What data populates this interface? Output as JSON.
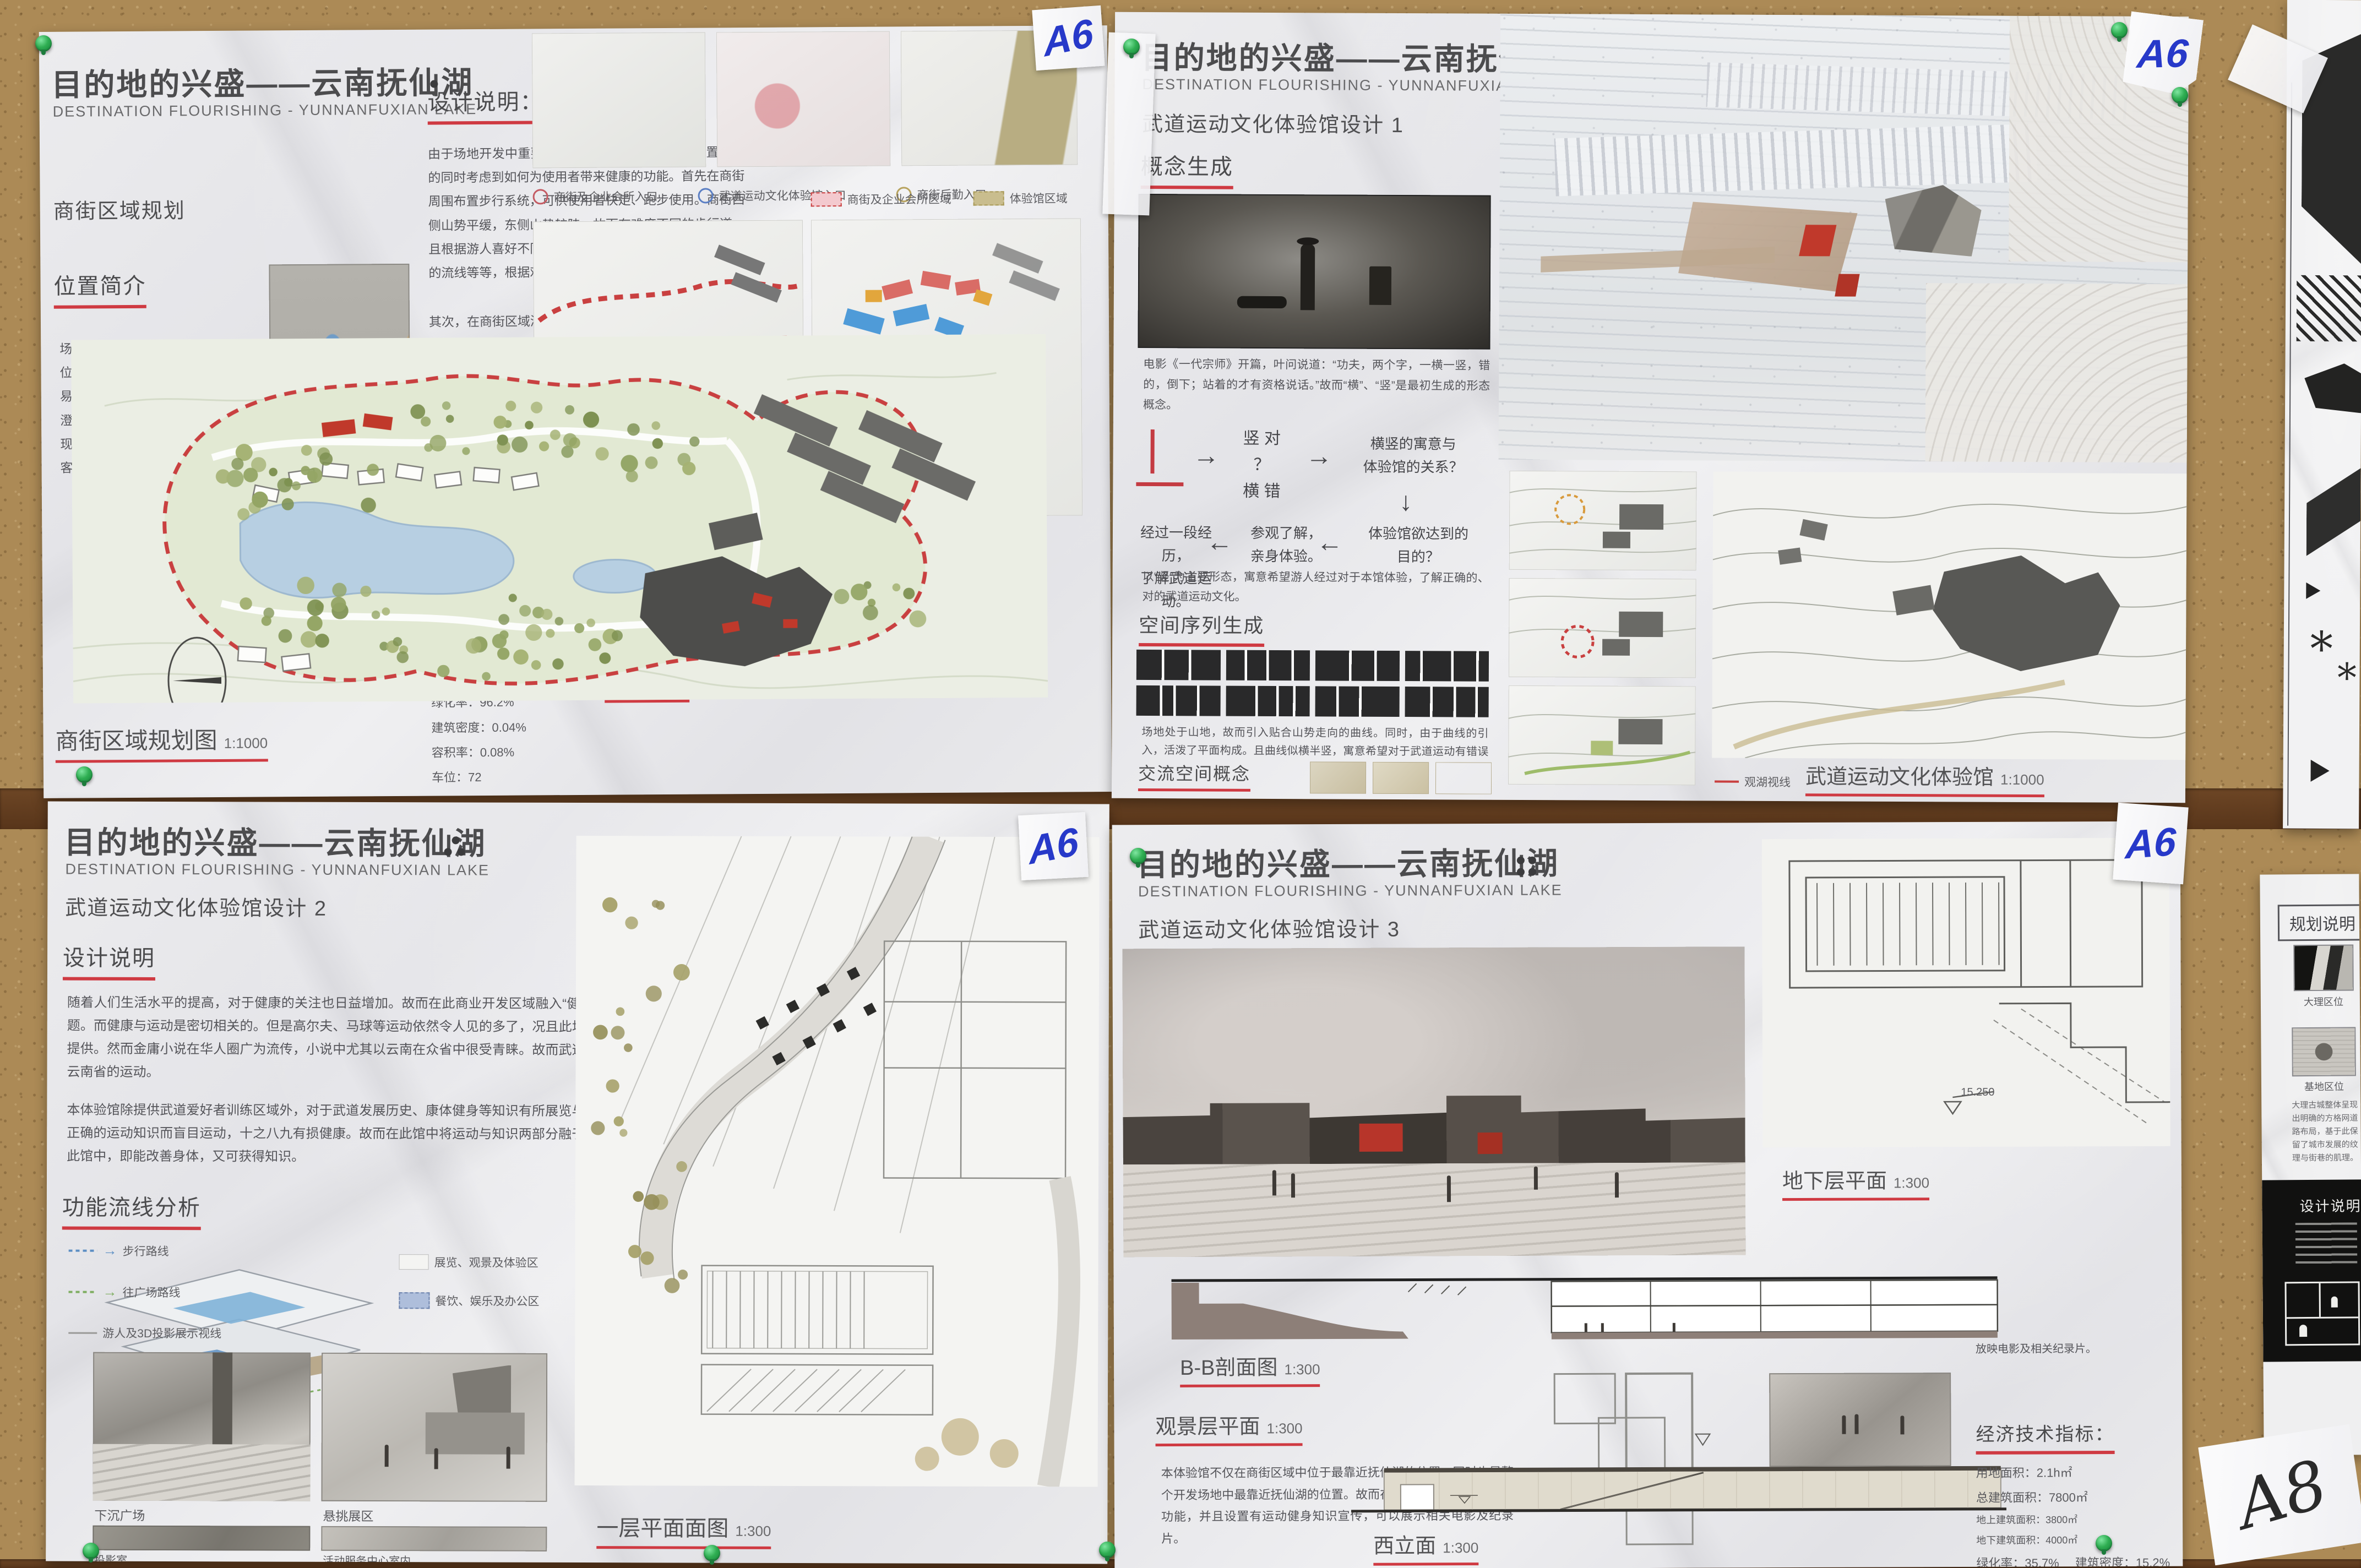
{
  "board": {
    "tape_label_a6": "A6",
    "tape_label_a8": "A8",
    "accent_red": "#cf3a42",
    "pin_green": "#2fae52",
    "cork_brown": "#ac8a56"
  },
  "posters": {
    "tl": {
      "title_cn": "目的地的兴盛——云南抚仙湖",
      "title_en": "DESTINATION FLOURISHING - YUNNANFUXIAN LAKE",
      "subtitle": "商街区域规划",
      "loc_heading": "位置简介",
      "loc_text": "场地位于云南抚仙湖的东岸。场地位置距离昆明、玉溪两市较远，不易享受大型城市的设施。但是距离澄江县只有32分钟车程，澄江县的现代服务业发展迅速，足以满足游客基本需求。",
      "design_heading": "设计说明：",
      "design_text_1": "由于场地开发中重要的“健康游”的主题，故而在布置商街的同时考虑到如何为使用者带来健康的功能。首先在商街周围布置步行系统，可供使用者快走、跑步使用。商街西侧山势平缓，东侧山势较陡，故而有难度不同的步行道。且根据游人喜好不同，有穿过人工水池的流线、穿越树林的流线等等，根据难度与景致不同有多种组合方式。",
      "design_text_2": "其次，在商街区域添加武道运动文化体验馆，为场地特色主题活动区。即可在此锻炼体魄，亦有文化知识相授。需要注意的是，此地位于高原，不宜未经适应即开始锻炼。但是正是因其位于高原，故而在准备充分后的锻炼效果更佳。",
      "design_text_3": "在商街南侧布置有企业会所，可供企业团体集体租住使用。同时商街内亦有小型客栈，并设有酒吧街、餐饮商业等功能，服务范围不局限于本项目场地客户，亦包含周围村落居民。",
      "econ_heading": "经济技术指标：",
      "econ_items": [
        "用地面积：23h㎡",
        "总建筑面积：17800㎡",
        "地上建筑面积：5500㎡",
        "地下建筑面积：7800㎡",
        "会所建筑面积：4500㎡",
        "绿化率：96.2%",
        "建筑密度：0.04%",
        "容积率：0.08%",
        "车位：72"
      ],
      "section_label": "A-A剖面图",
      "entry_legend": [
        "商街及企业会所入口",
        "武道运动文化体验馆入口",
        "商街后勤入口"
      ],
      "zone_legend": [
        "商街及企业会所区域",
        "体验馆区域"
      ],
      "road_legend": [
        "车行道路",
        "人行道路",
        "步行道路"
      ],
      "use_legend": [
        "住宿",
        "餐饮",
        "商业"
      ],
      "plan_label": "商街区域规划图",
      "plan_scale": "1:1000"
    },
    "tr": {
      "title_cn": "目的地的兴盛——云南抚仙湖",
      "title_en": "DESTINATION FLOURISHING - YUNNANFUXIAN LAKE",
      "subtitle": "武道运动文化体验馆设计 1",
      "concept_heading": "概念生成",
      "movie_caption": "电影《一代宗师》开篇，叶问说道：“功夫，两个字，一横一竖，错的，倒下；站着的才有资格说话。”故而“横”、“竖”是最初生成的形态概念。",
      "flow_v": "竖  对",
      "flow_q": "？",
      "flow_h": "横  错",
      "flow_r1": "横竖的寓意与\n体验馆的关系？",
      "flow_r2": "体验馆欲达到的\n目的？",
      "flow_r3": "参观了解，\n亲身体验。",
      "flow_r4": "经过一段经历，\n了解武道运动。",
      "flow_note": "以“竖”为主要形态，寓意希望游人经过对于本馆体验，了解正确的、对的武道运动文化。",
      "seq_heading": "空间序列生成",
      "seq_text": "场地处于山地，故而引入贴合山势走向的曲线。同时，由于曲线的引入，活泼了平面构成。且曲线似横半竖，寓意希望对于武道运动有错误认识的人经过本体验馆，可以了解正确的事实，达到“竖”的行列。",
      "comm_heading": "交流空间概念",
      "comm_text": "重点的交流空间，人们轻松愉悦交流，不同位置的交流空间供不同人群使用，交流武道运动文化。",
      "view_legend": "观湖视线",
      "plan_label": "武道运动文化体验馆",
      "plan_scale": "1:1000"
    },
    "bl": {
      "title_cn": "目的地的兴盛——云南抚仙湖",
      "title_en": "DESTINATION FLOURISHING - YUNNANFUXIAN LAKE",
      "subtitle": "武道运动文化体验馆设计 2",
      "design_heading": "设计说明",
      "design_text_1": "随着人们生活水平的提高，对于健康的关注也日益增加。故而在此商业开发区域融入“健康游”这一度假主题。而健康与运动是密切相关的。但是高尔夫、马球等运动依然令人见的多了，况且此场地并无足够面积提供。然而金庸小说在华人圈广为流传，小说中尤其以云南在众省中很受青睐。故而武道运动是最能代表云南省的运动。",
      "design_text_2": "本体验馆除提供武道爱好者训练区域外，对于武道发展历史、康体健身等知识有所展览与传授。因为若无正确的运动知识而盲目运动，十之八九有损健康。故而在此馆中将运动与知识两部分融于其中，使游人在此馆中，即能改善身体，又可获得知识。",
      "flow_heading": "功能流线分析",
      "flow_legend": [
        "步行路线",
        "往广场路线",
        "游人及3D投影展示视线"
      ],
      "zone_legend": [
        "展览、观景及体验区",
        "餐饮、娱乐及办公区"
      ],
      "photo_captions": [
        "下沉广场",
        "悬挑展区",
        "投影室",
        "活动服务中心室内"
      ],
      "plan_label": "一层平面面图",
      "plan_scale": "1:300"
    },
    "br": {
      "title_cn": "目的地的兴盛——云南抚仙湖",
      "title_en": "DESTINATION FLOURISHING - YUNNANFUXIAN LAKE",
      "subtitle": "武道运动文化体验馆设计 3",
      "plan1_label": "地下层平面",
      "plan1_scale": "1:300",
      "level_label": "15.250",
      "section_label": "B-B剖面图",
      "section_scale": "1:300",
      "plan2_label": "观景层平面",
      "plan2_scale": "1:300",
      "view_text": "本体验馆不仅在商街区域中位于最靠近抚仙湖的位置，同时也是整个开发场地中最靠近抚仙湖的位置。故而在功能设置中融入了观景功能，并且设置有运动健身知识宣传，可以展示相关电影及纪录片。",
      "elev_label": "西立面",
      "elev_scale": "1:300",
      "note_text": "放映电影及相关纪录片。",
      "econ_heading": "经济技术指标：",
      "econ_items": [
        "用地面积：2.1h㎡",
        "总建筑面积：7800㎡",
        "地上建筑面积：3800㎡",
        "地下建筑面积：4000㎡",
        "绿化率：35.7%",
        "建筑密度：15.2%",
        "容积率：37.1%",
        "停车位：20"
      ]
    },
    "right_bottom": {
      "header": "规划说明",
      "caption_1": "大理区位",
      "caption_2": "基地区位",
      "para": "大理古城整体呈现出明确的方格网道路布局，基于此保留了城市发展的纹理与街巷的肌理。",
      "band_heading": "设计说明"
    }
  }
}
